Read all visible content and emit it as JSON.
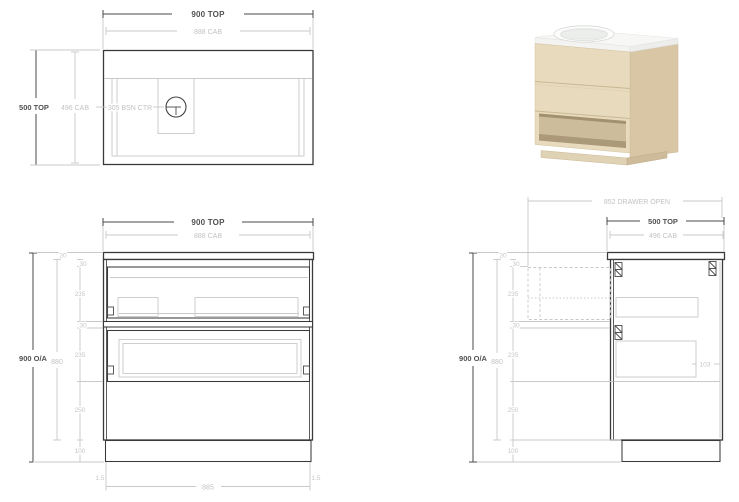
{
  "plan": {
    "width_top": "900 TOP",
    "width_cab": "888 CAB",
    "depth_top": "500 TOP",
    "depth_cab": "496 CAB",
    "basin_ctr": "305 BSN CTR"
  },
  "front": {
    "width_top": "900 TOP",
    "width_cab": "888 CAB",
    "height_oa": "900 O/A",
    "height_cab": "880",
    "top_thk": "20",
    "gap_a": "30",
    "drawer_a": "235",
    "gap_b": "30",
    "drawer_b": "235",
    "shelf": "250",
    "kick": "100",
    "kick_side_l": "1.5",
    "kick_side_r": "1.5",
    "kick_width": "885"
  },
  "side": {
    "drawer_open": "852 DRAWER OPEN",
    "depth_top": "500 TOP",
    "depth_cab": "496 CAB",
    "height_oa": "900 O/A",
    "height_cab": "880",
    "top_thk": "20",
    "gap_a": "30",
    "drawer_a": "235",
    "gap_b": "30",
    "drawer_b": "235",
    "shelf": "250",
    "kick": "100",
    "runner_gap": "103"
  },
  "colors": {
    "dark_line": "#3a3a3c",
    "dim_dark": "#515153",
    "dim_light": "#c2c2c2",
    "wood_front": "#e8dabd",
    "wood_side": "#d8c6a5",
    "wood_recess": "#bfae8c",
    "top_white": "#f7f7f5"
  }
}
